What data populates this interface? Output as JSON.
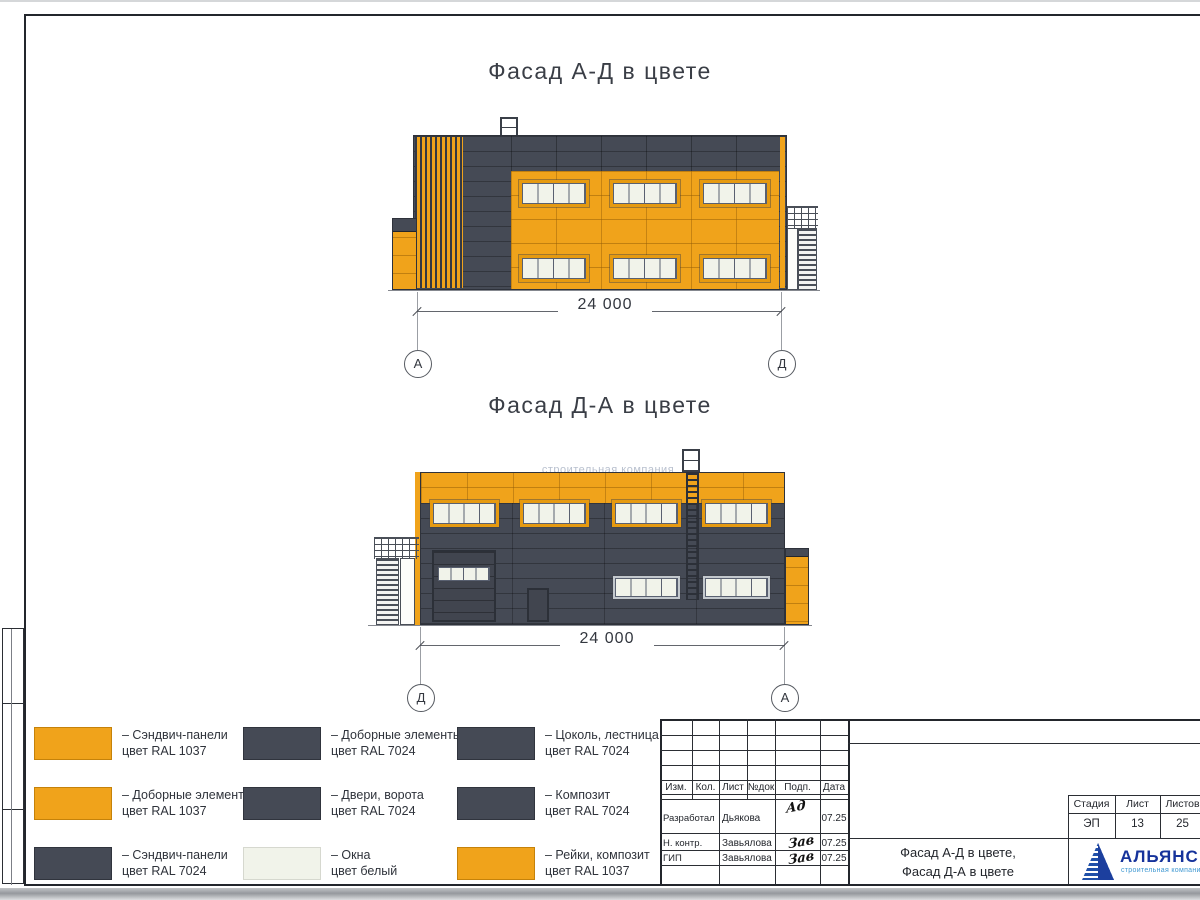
{
  "colors": {
    "orange": "#F0A31B",
    "dark": "#454A55",
    "window": "#F1F3EA",
    "logo_blue": "#1C3F9E",
    "logo_light": "#3F98D2"
  },
  "titles": {
    "f1": "Фасад А-Д в цвете",
    "f2": "Фасад Д-А в цвете"
  },
  "dims": {
    "f1": "24 000",
    "f2": "24 000"
  },
  "axes": {
    "f1_left": "А",
    "f1_right": "Д",
    "f2_left": "Д",
    "f2_right": "А"
  },
  "watermark": "строительная компания",
  "legend": {
    "items": [
      {
        "swatch": "orange",
        "line1": "– Сэндвич-панели",
        "line2": "цвет RAL 1037"
      },
      {
        "swatch": "orange",
        "line1": "– Доборные элементы",
        "line2": "цвет RAL 1037"
      },
      {
        "swatch": "dark",
        "line1": "– Сэндвич-панели",
        "line2": "цвет RAL 7024"
      },
      {
        "swatch": "dark",
        "line1": "– Доборные элементы",
        "line2": "цвет RAL 7024"
      },
      {
        "swatch": "dark",
        "line1": "– Двери, ворота",
        "line2": "цвет RAL 7024"
      },
      {
        "swatch": "white",
        "line1": "– Окна",
        "line2": "цвет белый"
      },
      {
        "swatch": "dark",
        "line1": "– Цоколь, лестница",
        "line2": "цвет RAL 7024"
      },
      {
        "swatch": "dark",
        "line1": "– Композит",
        "line2": "цвет RAL 7024"
      },
      {
        "swatch": "orange",
        "line1": "– Рейки, композит",
        "line2": "цвет RAL 1037"
      }
    ]
  },
  "stamp": {
    "header_cols": [
      "Изм.",
      "Кол.",
      "Лист",
      "№док",
      "Подп.",
      "Дата"
    ],
    "rows": [
      {
        "role": "Разработал",
        "name": "Дьякова",
        "sig": "Ад",
        "date": "07.25"
      },
      {
        "role": "Н. контр.",
        "name": "Завьялова",
        "sig": "Зав",
        "date": "07.25"
      },
      {
        "role": "ГИП",
        "name": "Завьялова",
        "sig": "Зав",
        "date": "07.25"
      }
    ],
    "stage_cols": [
      "Стадия",
      "Лист",
      "Листов"
    ],
    "stage_vals": [
      "ЭП",
      "13",
      "25"
    ],
    "doc_title_line1": "Фасад А-Д в цвете,",
    "doc_title_line2": "Фасад Д-А в цвете",
    "logo_text": "АЛЬЯНС",
    "logo_sub": "строительная компания"
  }
}
